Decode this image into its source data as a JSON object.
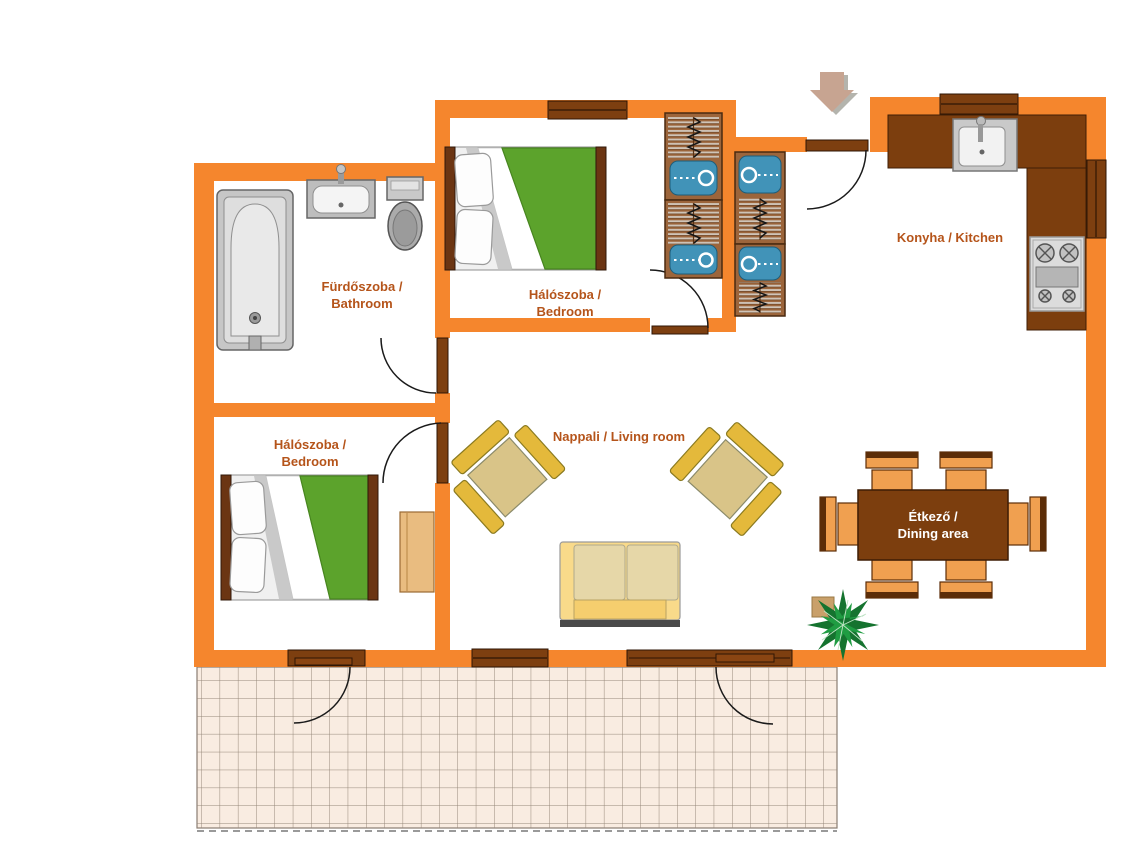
{
  "rooms": {
    "bathroom": {
      "label_line1": "Fürdőszoba /",
      "label_line2": "Bathroom"
    },
    "bedroom_top": {
      "label_line1": "Hálószoba /",
      "label_line2": "Bedroom"
    },
    "bedroom_left": {
      "label_line1": "Hálószoba /",
      "label_line2": "Bedroom"
    },
    "kitchen": {
      "label": "Konyha / Kitchen"
    },
    "living_room": {
      "label": "Nappali / Living room"
    },
    "dining_area": {
      "label_line1": "Étkező /",
      "label_line2": "Dining area"
    }
  },
  "objects": {
    "entry_arrow": "entry-direction-arrow",
    "bathtub": "bathtub",
    "washbasin": "washbasin",
    "toilet": "toilet",
    "bed_top": "double-bed-green-cover",
    "bed_left": "double-bed-green-cover",
    "wardrobes": "wardrobe-cabinets-with-hangers",
    "dresser": "dresser",
    "kitchen_counter": "l-shaped-kitchen-counter",
    "kitchen_sink": "kitchen-sink",
    "stove": "stove-4-burner",
    "armchairs": "armchair-x2",
    "sofa": "sofa",
    "dining_table": "dining-table",
    "dining_chairs": "dining-chair-x6",
    "plant": "potted-plant",
    "terrace": "tiled-terrace"
  },
  "colors": {
    "wall": "#f5862d",
    "wood_dark": "#7d3f10",
    "label_text": "#b5541a",
    "bed_cover_green": "#5ca32c",
    "wardrobe_brown": "#9c653b",
    "wardrobe_blue": "#4193b8",
    "chair_orange": "#f0a050",
    "armchair_yellow": "#e4b93b",
    "sofa_yellow": "#f9da8a",
    "tile": "#f9ece1",
    "table_text": "#ffffff"
  }
}
